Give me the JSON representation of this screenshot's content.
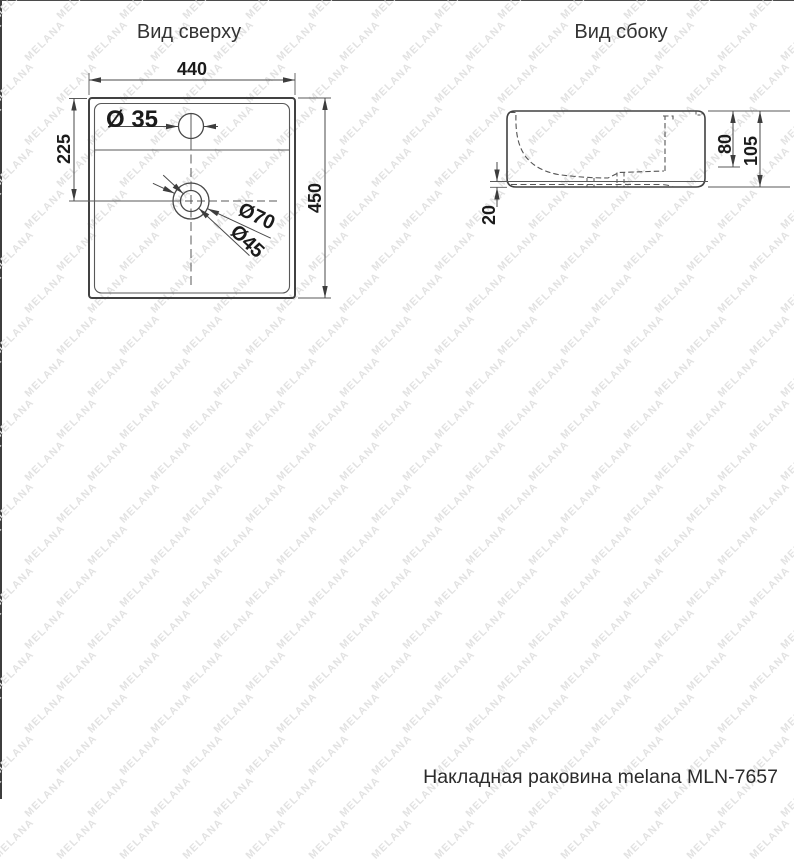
{
  "page": {
    "watermark_text": "MELANA",
    "watermark_color": "#e2e2e2",
    "line_color": "#4a4a4a",
    "text_color": "#1b1b1b"
  },
  "top_view": {
    "title": "Вид сверху",
    "dim_width": "440",
    "dim_height": "450",
    "dim_faucet_offset": "225",
    "label_faucet_hole": "Ø 35",
    "label_drain_outer": "Ø70",
    "label_drain_inner": "Ø45"
  },
  "side_view": {
    "title": "Вид сбоку",
    "dim_basin_depth": "80",
    "dim_total_height": "105",
    "dim_base_height": "20"
  },
  "footer": {
    "caption": "Накладная раковина melana MLN-7657"
  }
}
